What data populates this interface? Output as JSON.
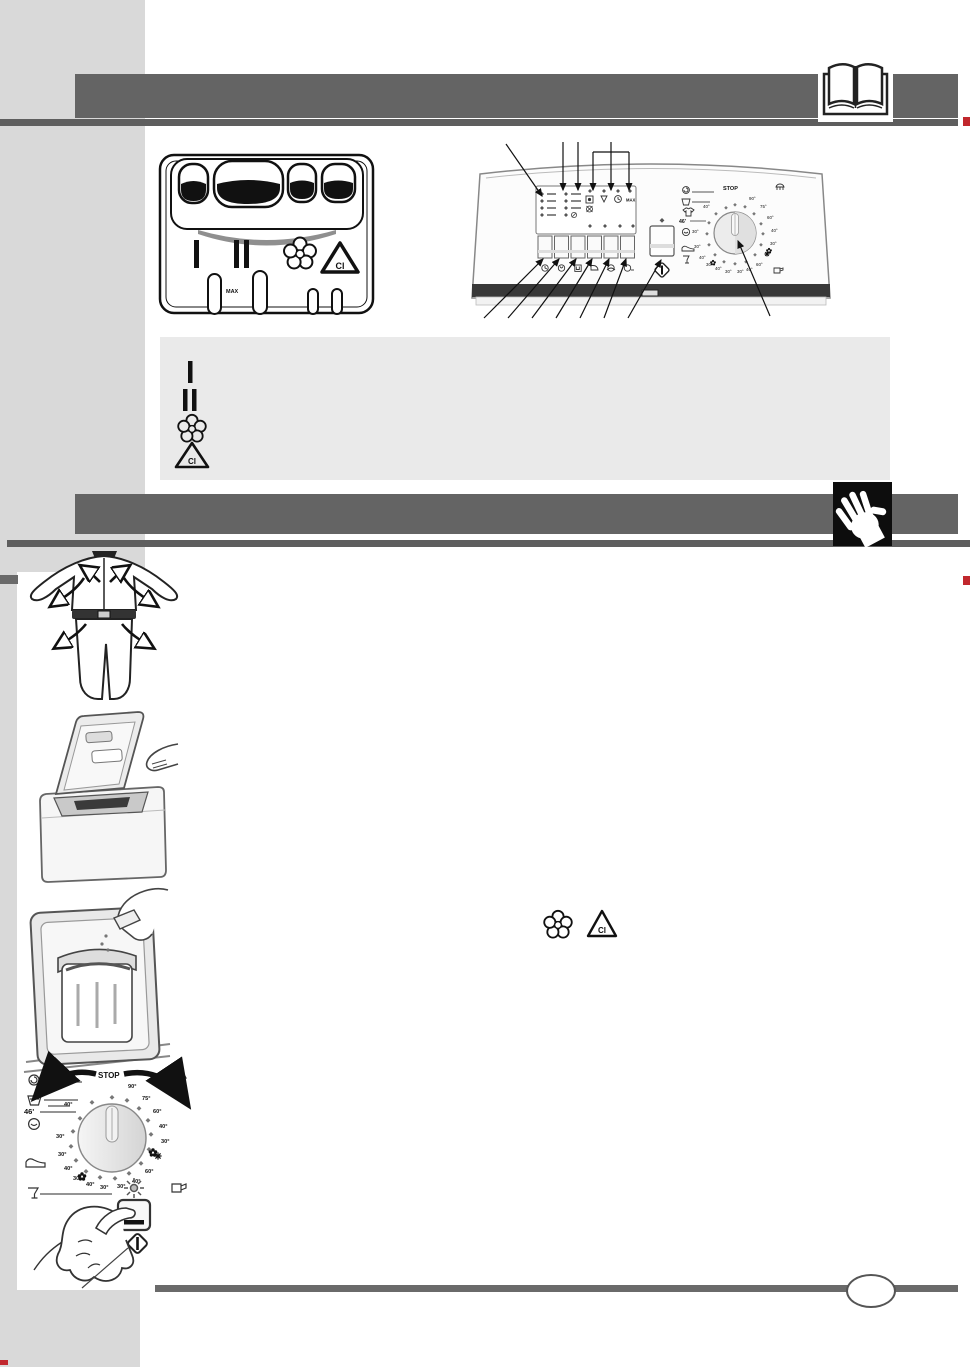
{
  "colors": {
    "sidebar": "#d9d9d9",
    "header_bar": "#646464",
    "thin_rule": "#5e5e5e",
    "legend_box": "#eaeaea",
    "footer_rule": "#6a6a6a",
    "accent_red": "#c1272d",
    "panel_band": "#383838"
  },
  "header1": {
    "icon": "open-book-icon"
  },
  "header2": {
    "icon": "stop-hand-icon"
  },
  "dispenser": {
    "symbol_I": "I",
    "symbol_II": "II",
    "bleach_cl": "Cl",
    "max": "MAX",
    "compartments": [
      "prewash-small",
      "mainwash-large",
      "softener-small",
      "bleach-small"
    ]
  },
  "panel": {
    "max": "MAX",
    "led_columns": 2,
    "led_rows": 4,
    "button_count": 6,
    "icons": {
      "led_row": [
        "spin-boxed-icon",
        "drain-triangle-icon",
        "clock-icon"
      ],
      "buttons": [
        "delay-icon",
        "prewash-icon",
        "extra-rinse-icon",
        "easy-iron-icon",
        "rinse-hold-icon",
        "drain-icon"
      ],
      "start": "start-pause-diamond-icon"
    }
  },
  "dial": {
    "stop": "STOP",
    "quick": "46'",
    "right": [
      "90°",
      "75°",
      "60°",
      "40°",
      "30°"
    ],
    "lower_right": [
      "60°",
      "40°",
      "30°"
    ],
    "bottom": [
      "30°",
      "40°",
      "30°"
    ],
    "left": [
      "40°",
      "30°",
      "30°",
      "40°"
    ],
    "icons_left": [
      "cotton-spiral-icon",
      "tub-icon",
      "handwash-icon",
      "sneaker-icon",
      "glass-icon"
    ],
    "icons_right": [
      "basket-icon",
      "snowflake-icon",
      "jug-icon"
    ]
  },
  "legend": {
    "symbol_I": "I",
    "symbol_II": "II",
    "bleach_cl": "Cl",
    "softener": "softener-flower-icon"
  },
  "inline_symbols": {
    "softener": "softener-flower-icon",
    "bleach_cl": "Cl"
  },
  "figures": [
    "check-pockets-garment",
    "open-lid-load-laundry",
    "pour-detergent-in-drawer",
    "turn-program-dial",
    "press-start-button"
  ]
}
